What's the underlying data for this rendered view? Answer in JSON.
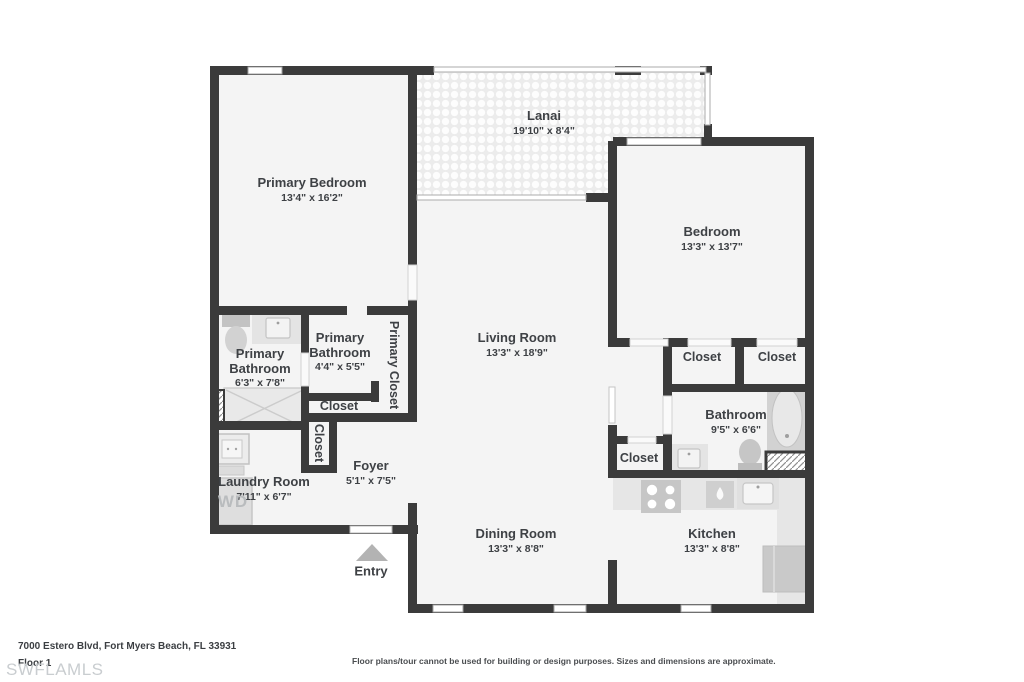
{
  "floorplan": {
    "rooms": {
      "primary_bedroom": {
        "name": "Primary Bedroom",
        "dims": "13'4\" x 16'2\""
      },
      "lanai": {
        "name": "Lanai",
        "dims": "19'10\" x 8'4\""
      },
      "bedroom": {
        "name": "Bedroom",
        "dims": "13'3\" x 13'7\""
      },
      "living_room": {
        "name": "Living Room",
        "dims": "13'3\" x 18'9\""
      },
      "primary_bathroom_main": {
        "name": "Primary Bathroom",
        "dims": "6'3\" x 7'8\""
      },
      "primary_bathroom_small": {
        "name": "Primary Bathroom",
        "dims": "4'4\" x 5'5\""
      },
      "laundry_room": {
        "name": "Laundry Room",
        "dims": "7'11\" x 6'7\""
      },
      "foyer": {
        "name": "Foyer",
        "dims": "5'1\" x 7'5\""
      },
      "dining_room": {
        "name": "Dining Room",
        "dims": "13'3\" x 8'8\""
      },
      "kitchen": {
        "name": "Kitchen",
        "dims": "13'3\" x 8'8\""
      },
      "bathroom": {
        "name": "Bathroom",
        "dims": "9'5\" x 6'6\""
      }
    },
    "closets": {
      "primary_closet": "Primary Closet",
      "linen_closet": "Closet",
      "hallway_closet": "Closet",
      "bedroom_closet_left": "Closet",
      "bedroom_closet_right": "Closet",
      "hall_closet": "Closet"
    },
    "entry_label": "Entry",
    "washer_dryer_label": "WD"
  },
  "footer": {
    "address": "7000 Estero Blvd, Fort Myers Beach, FL 33931",
    "floor_label": "Floor 1",
    "watermark": "SWFLAMLS",
    "disclaimer": "Floor plans/tour cannot be used for building or design purposes. Sizes and dimensions are approximate."
  },
  "colors": {
    "wall": "#3b3b3b",
    "floor": "#f4f4f4",
    "fixture": "#d6d6d6",
    "text": "#3e4145"
  }
}
